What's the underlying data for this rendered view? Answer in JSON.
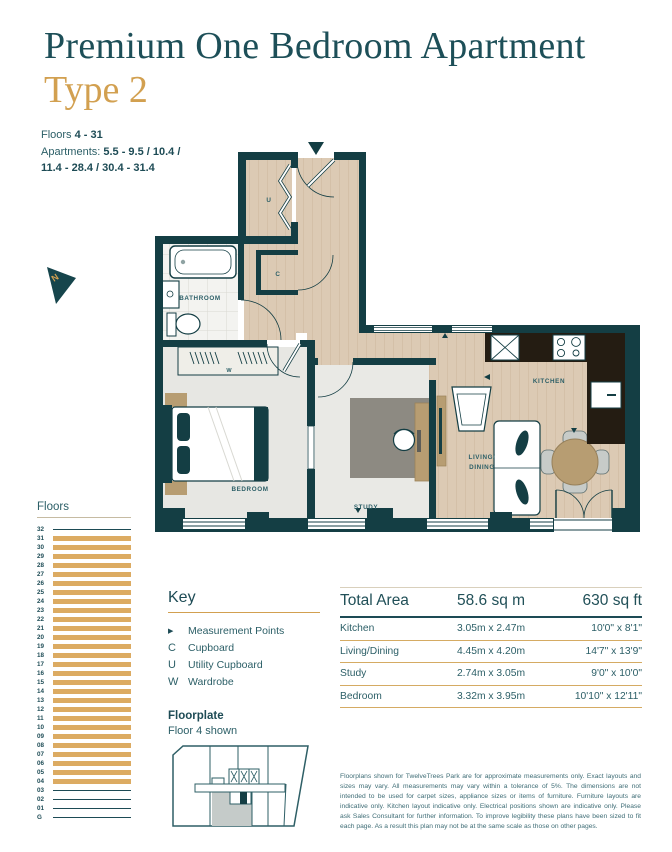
{
  "header": {
    "title": "Premium One Bedroom Apartment",
    "subtitle": "Type 2"
  },
  "meta": {
    "floors_label": "Floors ",
    "floors_value": "4 - 31",
    "apartments_label": "Apartments: ",
    "apartments_line1": "5.5 - 9.5 / 10.4 /",
    "apartments_line2": "11.4 - 28.4 / 30.4 - 31.4"
  },
  "compass": {
    "label": "N"
  },
  "plan": {
    "rooms": {
      "bathroom": "BATHROOM",
      "bedroom": "BEDROOM",
      "study": "STUDY",
      "living_line1": "LIVING/",
      "living_line2": "DINING",
      "kitchen": "KITCHEN",
      "utility": "U",
      "cupboard": "C",
      "wardrobe": "W"
    }
  },
  "floors_panel": {
    "title": "Floors",
    "floors": [
      {
        "label": "32",
        "bar": false
      },
      {
        "label": "31",
        "bar": true
      },
      {
        "label": "30",
        "bar": true
      },
      {
        "label": "29",
        "bar": true
      },
      {
        "label": "28",
        "bar": true
      },
      {
        "label": "27",
        "bar": true
      },
      {
        "label": "26",
        "bar": true
      },
      {
        "label": "25",
        "bar": true
      },
      {
        "label": "24",
        "bar": true
      },
      {
        "label": "23",
        "bar": true
      },
      {
        "label": "22",
        "bar": true
      },
      {
        "label": "21",
        "bar": true
      },
      {
        "label": "20",
        "bar": true
      },
      {
        "label": "19",
        "bar": true
      },
      {
        "label": "18",
        "bar": true
      },
      {
        "label": "17",
        "bar": true
      },
      {
        "label": "16",
        "bar": true
      },
      {
        "label": "15",
        "bar": true
      },
      {
        "label": "14",
        "bar": true
      },
      {
        "label": "13",
        "bar": true
      },
      {
        "label": "12",
        "bar": true
      },
      {
        "label": "11",
        "bar": true
      },
      {
        "label": "10",
        "bar": true
      },
      {
        "label": "09",
        "bar": true
      },
      {
        "label": "08",
        "bar": true
      },
      {
        "label": "07",
        "bar": true
      },
      {
        "label": "06",
        "bar": true
      },
      {
        "label": "05",
        "bar": true
      },
      {
        "label": "04",
        "bar": true
      },
      {
        "label": "03",
        "bar": false
      },
      {
        "label": "02",
        "bar": false
      },
      {
        "label": "01",
        "bar": false
      },
      {
        "label": "G",
        "bar": false
      }
    ]
  },
  "key": {
    "title": "Key",
    "items": [
      {
        "symbol": "▶",
        "label": "Measurement Points",
        "tri": true
      },
      {
        "symbol": "C",
        "label": "Cupboard",
        "tri": false
      },
      {
        "symbol": "U",
        "label": "Utility Cupboard",
        "tri": false
      },
      {
        "symbol": "W",
        "label": "Wardrobe",
        "tri": false
      }
    ]
  },
  "floorplate": {
    "title": "Floorplate",
    "subtitle": "Floor 4 shown"
  },
  "areas_table": {
    "header": {
      "c1": "Total Area",
      "c2": "58.6 sq m",
      "c3": "630 sq ft"
    },
    "rows": [
      {
        "name": "Kitchen",
        "metric": "3.05m x 2.47m",
        "imperial": "10'0\" x 8'1\""
      },
      {
        "name": "Living/Dining",
        "metric": "4.45m x 4.20m",
        "imperial": "14'7\" x 13'9\""
      },
      {
        "name": "Study",
        "metric": "2.74m x 3.05m",
        "imperial": "9'0\" x 10'0\""
      },
      {
        "name": "Bedroom",
        "metric": "3.32m x 3.95m",
        "imperial": "10'10\" x 12'11\""
      }
    ]
  },
  "disclaimer": "Floorplans shown for TwelveTrees Park are for approximate measurements only. Exact layouts and sizes may vary. All measurements may vary within a tolerance of 5%. The dimensions are not intended to be used for carpet sizes, appliance sizes or items of furniture. Furniture layouts are indicative only. Kitchen layout indicative only. Electrical positions shown are indicative only. Please ask Sales Consultant for further information. To improve legibility these plans have been sized to fit each page. As a result this plan may not be at the same scale as those on other pages.",
  "colors": {
    "wall_teal": "#143e44",
    "accent_gold": "#d2a050",
    "bar_gold": "#dcab62",
    "title_teal": "#1d4f58"
  }
}
